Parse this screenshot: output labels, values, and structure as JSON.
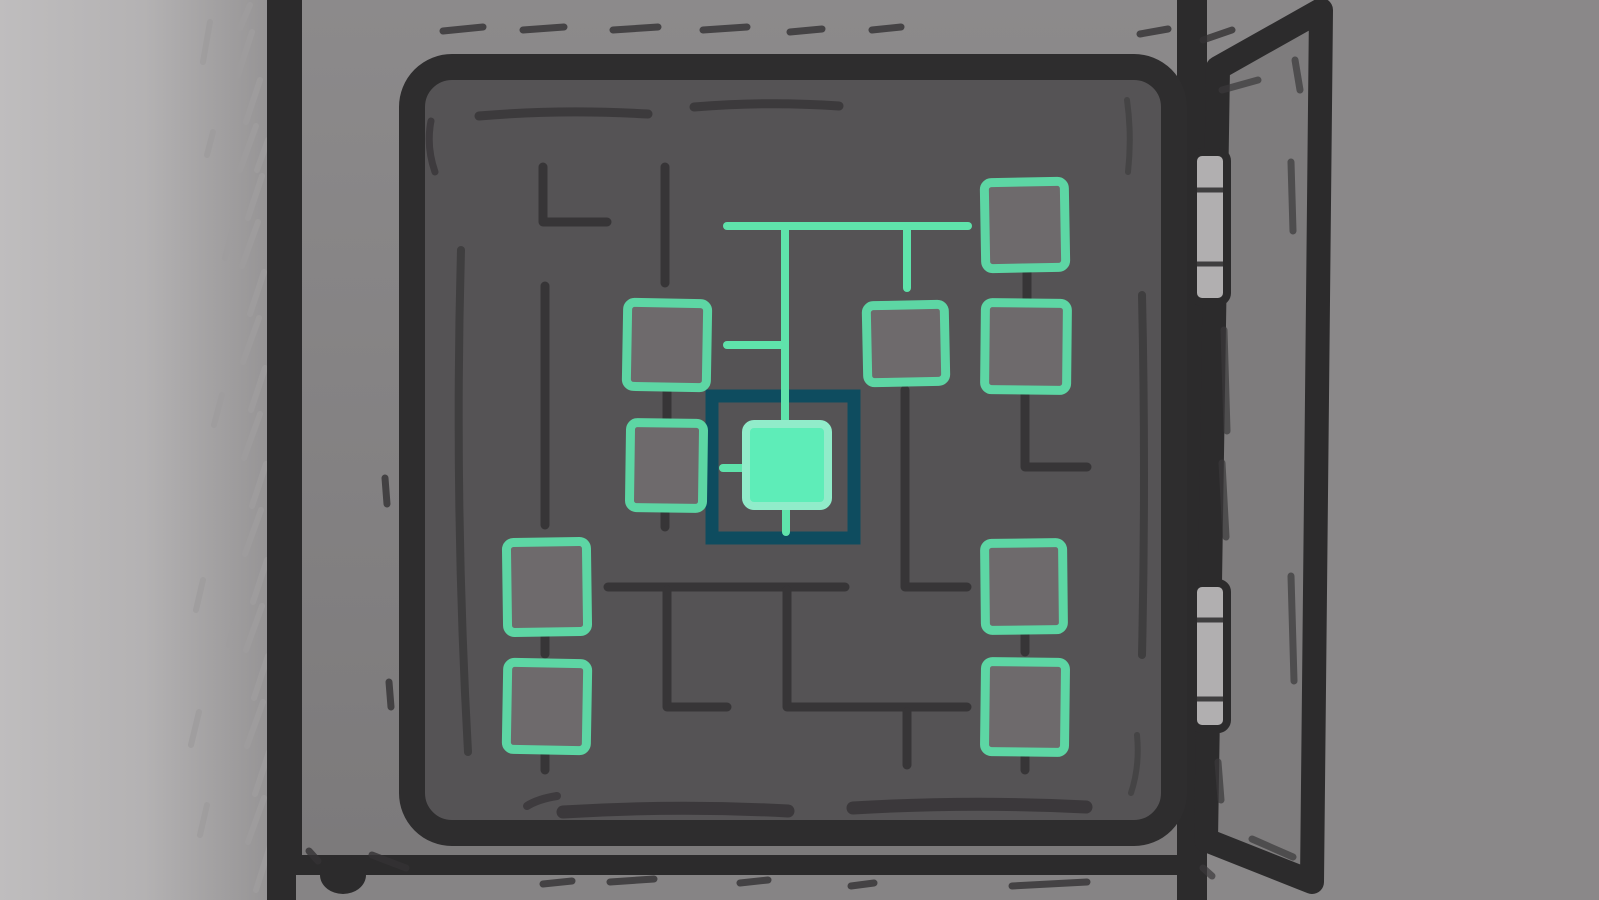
{
  "scene": {
    "type": "game",
    "name": "fuse-box-circuit-puzzle",
    "description": "Hand-drawn wall-mounted electrical fuse box with its door open, showing a circuit puzzle: nine empty teal square fuse sockets connected by dark traces, a glowing teal wire path descending from the top bus, and one powered (filled) fuse highlighted by a dark-teal selection cursor frame.",
    "colors": {
      "wallLight": "#bfbdbe",
      "wallMid": "#b4b2b3",
      "wallShadow": "#9b999a",
      "wallDark": "#8a8889",
      "boxFaceTop": "#8c8a8b",
      "boxFaceBottom": "#7b797a",
      "boxBottomStrip": "#868485",
      "outline": "#2c2b2c",
      "panelFill": "#555355",
      "panelFrame": "#2e2d2e",
      "trace": "#373537",
      "sketch": "#343234",
      "wire": "#5fe3ab",
      "nodeFill": "#6e6a6c",
      "nodeBorder": "#5dd6a4",
      "cursorFrame": "#0e4c5f",
      "selectedFill": "#5eedb8",
      "selectedBorder": "#91ecca",
      "hingeFill": "#b1afb0",
      "doorFace": "#7e7c7d",
      "hatch": "#9f9d9e"
    }
  },
  "board": {
    "node_count": 9,
    "nodes": [
      {
        "id": "top-right",
        "x": 985,
        "y": 182,
        "w": 80,
        "h": 86,
        "tilt": -1.0,
        "state": "empty"
      },
      {
        "id": "mid-left",
        "x": 627,
        "y": 303,
        "w": 80,
        "h": 84,
        "tilt": 1.0,
        "state": "empty"
      },
      {
        "id": "mid-center",
        "x": 867,
        "y": 305,
        "w": 78,
        "h": 77,
        "tilt": -1.2,
        "state": "empty"
      },
      {
        "id": "mid-right",
        "x": 985,
        "y": 303,
        "w": 82,
        "h": 87,
        "tilt": 0.6,
        "state": "empty"
      },
      {
        "id": "mid-left-lower",
        "x": 630,
        "y": 423,
        "w": 73,
        "h": 85,
        "tilt": 0.8,
        "state": "empty"
      },
      {
        "id": "bottom-left-1",
        "x": 507,
        "y": 542,
        "w": 80,
        "h": 90,
        "tilt": -0.8,
        "state": "empty"
      },
      {
        "id": "bottom-left-2",
        "x": 507,
        "y": 663,
        "w": 80,
        "h": 87,
        "tilt": 1.0,
        "state": "empty"
      },
      {
        "id": "bottom-right-1",
        "x": 985,
        "y": 543,
        "w": 78,
        "h": 87,
        "tilt": -0.6,
        "state": "empty"
      },
      {
        "id": "bottom-right-2",
        "x": 985,
        "y": 662,
        "w": 80,
        "h": 90,
        "tilt": 0.7,
        "state": "empty"
      }
    ],
    "selected": {
      "id": "center-powered",
      "state": "filled",
      "frame": {
        "x": 712,
        "y": 396,
        "w": 142,
        "h": 142
      },
      "node": {
        "x": 746,
        "y": 424,
        "w": 82,
        "h": 82
      }
    },
    "wires": [
      "M727,226 H968",
      "M785,226 V424",
      "M907,226 V288",
      "M727,345 H784",
      "M723,468 H748",
      "M786,505 V532"
    ],
    "traces": [
      "M543,167 V222 H607",
      "M665,167 V283",
      "M545,286 V525",
      "M667,389 V421",
      "M665,510 V527",
      "M608,587 H845",
      "M667,590 V707 H727",
      "M787,590 V707 H967",
      "M907,712 V765",
      "M905,390 V587 H967",
      "M1025,390 V467 H1087",
      "M1027,268 V300",
      "M1025,630 V652",
      "M1025,752 V770",
      "M545,632 V654",
      "M545,750 V770"
    ]
  },
  "door": {
    "points": "1218,68 1321,10 1312,882 1206,840",
    "strokes": [
      [
        1222,
        90,
        1258,
        80
      ],
      [
        1295,
        60,
        1300,
        90
      ],
      [
        1291,
        162,
        1293,
        231
      ],
      [
        1224,
        330,
        1227,
        431
      ],
      [
        1222,
        463,
        1226,
        537
      ],
      [
        1291,
        576,
        1294,
        681
      ],
      [
        1218,
        762,
        1221,
        800
      ],
      [
        1252,
        839,
        1293,
        857
      ],
      [
        1203,
        868,
        1212,
        876
      ]
    ]
  },
  "hinges": [
    {
      "x": 1193,
      "y": 152,
      "w": 34,
      "h": 150,
      "div": [
        190,
        264
      ]
    },
    {
      "x": 1193,
      "y": 583,
      "w": 34,
      "h": 146,
      "div": [
        620,
        699
      ]
    }
  ],
  "bolt": {
    "cx": 343,
    "cy": 875,
    "rx": 23,
    "ry": 19
  },
  "decor": {
    "wallHatches": [
      [
        238,
        75,
        252,
        32
      ],
      [
        246,
        122,
        260,
        80
      ],
      [
        240,
        170,
        256,
        126
      ],
      [
        248,
        218,
        262,
        176
      ],
      [
        242,
        266,
        258,
        222
      ],
      [
        250,
        314,
        264,
        272
      ],
      [
        243,
        362,
        259,
        318
      ],
      [
        251,
        410,
        265,
        368
      ],
      [
        244,
        458,
        260,
        414
      ],
      [
        252,
        506,
        266,
        464
      ],
      [
        245,
        554,
        261,
        510
      ],
      [
        253,
        602,
        267,
        560
      ],
      [
        246,
        650,
        262,
        606
      ],
      [
        254,
        698,
        268,
        656
      ],
      [
        247,
        746,
        263,
        702
      ],
      [
        255,
        794,
        269,
        752
      ],
      [
        248,
        842,
        264,
        798
      ],
      [
        256,
        890,
        270,
        846
      ],
      [
        240,
        28,
        250,
        5
      ],
      [
        257,
        170,
        268,
        140
      ],
      [
        203,
        62,
        210,
        22
      ],
      [
        207,
        155,
        213,
        132
      ],
      [
        214,
        425,
        222,
        395
      ],
      [
        196,
        610,
        203,
        580
      ],
      [
        191,
        745,
        199,
        712
      ],
      [
        200,
        835,
        207,
        805
      ],
      [
        225,
        258,
        233,
        228
      ],
      [
        229,
        645,
        236,
        618
      ]
    ],
    "faceDashes": [
      [
        443,
        31,
        483,
        27
      ],
      [
        523,
        30,
        564,
        27
      ],
      [
        613,
        30,
        658,
        27
      ],
      [
        703,
        30,
        747,
        27
      ],
      [
        790,
        32,
        822,
        29
      ],
      [
        872,
        30,
        901,
        27
      ],
      [
        1140,
        34,
        1168,
        29
      ],
      [
        1203,
        40,
        1232,
        30
      ],
      [
        543,
        884,
        572,
        881
      ],
      [
        610,
        882,
        654,
        879
      ],
      [
        740,
        883,
        768,
        880
      ],
      [
        851,
        886,
        874,
        883
      ],
      [
        1012,
        886,
        1087,
        882
      ],
      [
        385,
        478,
        387,
        504
      ],
      [
        389,
        682,
        391,
        707
      ],
      [
        1120,
        129,
        1122,
        171
      ],
      [
        309,
        851,
        318,
        861
      ],
      [
        372,
        855,
        406,
        868
      ]
    ],
    "panelStrokes": [
      {
        "d": "M479,116 Q560,109 648,114",
        "w": 9,
        "o": 0.75
      },
      {
        "d": "M694,107 Q768,101 839,106",
        "w": 9,
        "o": 0.75
      },
      {
        "d": "M431,121 Q426,146 435,172",
        "w": 7,
        "o": 0.7
      },
      {
        "d": "M461,250 Q454,500 468,752",
        "w": 8,
        "o": 0.65
      },
      {
        "d": "M1142,295 Q1146,475 1142,655",
        "w": 8,
        "o": 0.65
      },
      {
        "d": "M563,812 Q676,805 788,811",
        "w": 13,
        "o": 0.8
      },
      {
        "d": "M853,808 Q970,801 1086,807",
        "w": 13,
        "o": 0.8
      },
      {
        "d": "M527,806 Q538,799 557,796",
        "w": 8,
        "o": 0.7
      },
      {
        "d": "M1127,100 Q1132,136 1128,172",
        "w": 6,
        "o": 0.45
      },
      {
        "d": "M1137,735 Q1140,766 1131,793",
        "w": 6,
        "o": 0.45
      }
    ]
  }
}
